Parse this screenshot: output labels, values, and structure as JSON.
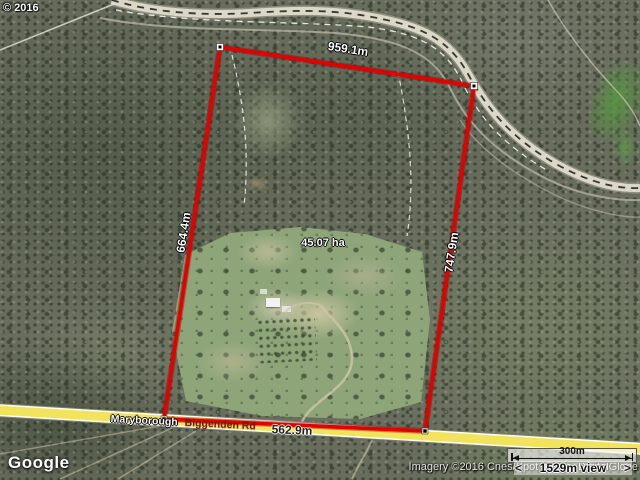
{
  "map": {
    "copyright": "© 2016",
    "google_logo": "Google",
    "attribution": "Imagery ©2016 Cnes/Spot Image, DigitalGlobe",
    "road_label": {
      "part1": "Maryborough",
      "part2": "Biggenden Rd"
    },
    "measurements": {
      "top": "959.1m",
      "left": "664.4m",
      "right": "747.9m",
      "bottom": "562.9m",
      "area": "45.07 ha"
    },
    "scale": {
      "bar_label": "300m",
      "prev": "<",
      "view_label": "1529m view",
      "next": ">"
    },
    "colors": {
      "boundary": "#e40000",
      "boundary_shadow": "#8b0000",
      "road_yellow": "#f2e35c",
      "road_name": "#7a1a00"
    }
  }
}
